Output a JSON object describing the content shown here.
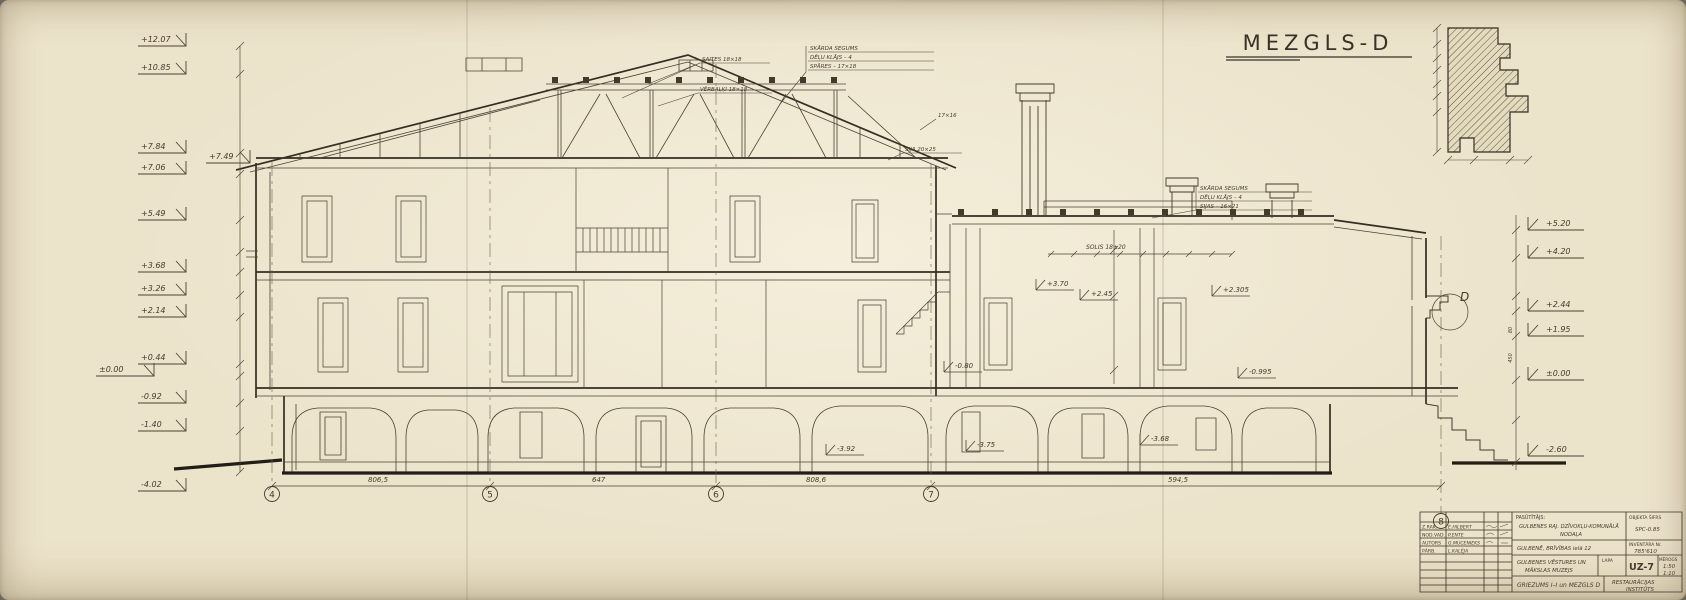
{
  "sheet": {
    "title": "MEZGLS-D",
    "detail_letter": "D"
  },
  "elevations": {
    "left": [
      "+12.07",
      "+10.85",
      "+7.84",
      "+7.06",
      "+7.49",
      "+5.49",
      "+3.68",
      "+3.26",
      "+2.14",
      "+0.44",
      "±0.00",
      "-0.92",
      "-1.40",
      "-4.02"
    ],
    "right": [
      "+5.20",
      "+4.20",
      "+2.44",
      "+1.95",
      "±0.00",
      "-2.60"
    ],
    "interior": [
      "+3.70",
      "+2.45",
      "+2.305",
      "-0.80",
      "-0.995",
      "-3.75",
      "-3.68",
      "-3.92"
    ]
  },
  "axes": {
    "a4": "4",
    "a5": "5",
    "a6": "6",
    "a7": "7",
    "a8": "8"
  },
  "dims": {
    "bottom": [
      "806,5",
      "647",
      "808,6",
      "594,5"
    ],
    "joist_note": "SOLIS 18±20",
    "right_chain": [
      "450",
      "80"
    ]
  },
  "notes": {
    "truss_tie": "SAITES 18×18",
    "truss_collar": "VĒRBAĻĶI 18×18",
    "rafter": "17×16",
    "beam": "SIJA 20×25",
    "legend_top": {
      "l1": "SKĀRDA SEGUMS",
      "l2": "DĒĻU KLĀJS – 4",
      "l3": "SPĀRES – 17×18"
    },
    "legend_wing": {
      "l1": "SKĀRDA SEGUMS",
      "l2": "DĒĻU KLĀJS – 4",
      "l3": "SIJAS – 16×21"
    }
  },
  "titleblock": {
    "staff": [
      {
        "role": "Z.RAK.",
        "name": "E.HILBERT"
      },
      {
        "role": "NOD.VAD.",
        "name": "P.ENTE"
      },
      {
        "role": "AUTORS",
        "name": "G.MUCENIEKS"
      },
      {
        "role": "PĀRB.",
        "name": "L.KALĒJA"
      }
    ],
    "client_label": "PASŪTĪTĀJS:",
    "client_l1": "GULBENES RAJ. DZĪVOKĻU-KOMUNĀLĀ",
    "client_l2": "NODAĻA",
    "code_label": "OBJEKTA ŠIFRS",
    "code": "SPC-0.85",
    "address": "GULBENĒ, BRĪVĪBAS ielā 12",
    "inventory_label": "INVENTĀRA Nr.",
    "inventory": "785'610",
    "object_l1": "GULBENES VĒSTURES UN",
    "object_l2": "MĀKSLAS MUZEJS",
    "sheet_label": "LAPA",
    "sheet_no": "UZ-7",
    "scale_label": "MĒROGS",
    "scale_1": "1:50",
    "scale_2": "1:10",
    "drawing_title": "GRIEZUMS I–I un MEZGLS D",
    "org_l1": "RESTAURĀCIJAS",
    "org_l2": "INSTITŪTS"
  }
}
